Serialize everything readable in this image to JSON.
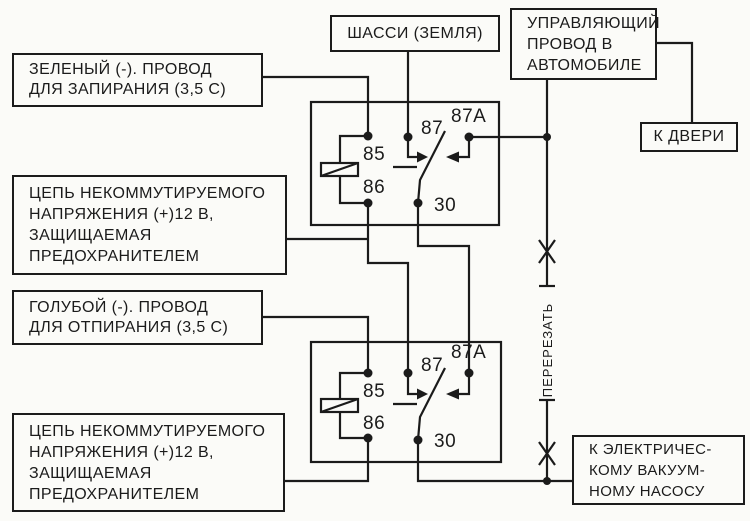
{
  "colors": {
    "ink": "#1b1b1b",
    "paper": "#fbfbf8"
  },
  "boxes": {
    "chassis": {
      "label": "ШАССИ (ЗЕМЛЯ)"
    },
    "control_wire": {
      "lines": [
        "УПРАВЛЯЮЩИЙ",
        "ПРОВОД В",
        "АВТОМОБИЛЕ"
      ]
    },
    "to_door": {
      "label": "К ДВЕРИ"
    },
    "green_lock": {
      "lines": [
        "ЗЕЛЕНЫЙ (-). ПРОВОД",
        "ДЛЯ ЗАПИРАНИЯ (3,5 С)"
      ]
    },
    "fused_top": {
      "lines": [
        "ЦЕПЬ НЕКОММУТИРУЕМОГО",
        "НАПРЯЖЕНИЯ (+)12 В,",
        "ЗАЩИЩАЕМАЯ",
        "ПРЕДОХРАНИТЕЛЕМ"
      ]
    },
    "blue_unlock": {
      "lines": [
        "ГОЛУБОЙ (-). ПРОВОД",
        "ДЛЯ ОТПИРАНИЯ (3,5 С)"
      ]
    },
    "fused_bottom": {
      "lines": [
        "ЦЕПЬ НЕКОММУТИРУЕМОГО",
        "НАПРЯЖЕНИЯ (+)12 В,",
        "ЗАЩИЩАЕМАЯ",
        "ПРЕДОХРАНИТЕЛЕМ"
      ]
    },
    "to_pump": {
      "lines": [
        "К ЭЛЕКТРИЧЕС-",
        "КОМУ ВАКУУМ-",
        "НОМУ НАСОСУ"
      ]
    }
  },
  "relay_terminals": {
    "t85": "85",
    "t86": "86",
    "t87": "87",
    "t87a": "87A",
    "t30": "30"
  },
  "cut_label": "ПЕРЕРЕЗАТЬ"
}
